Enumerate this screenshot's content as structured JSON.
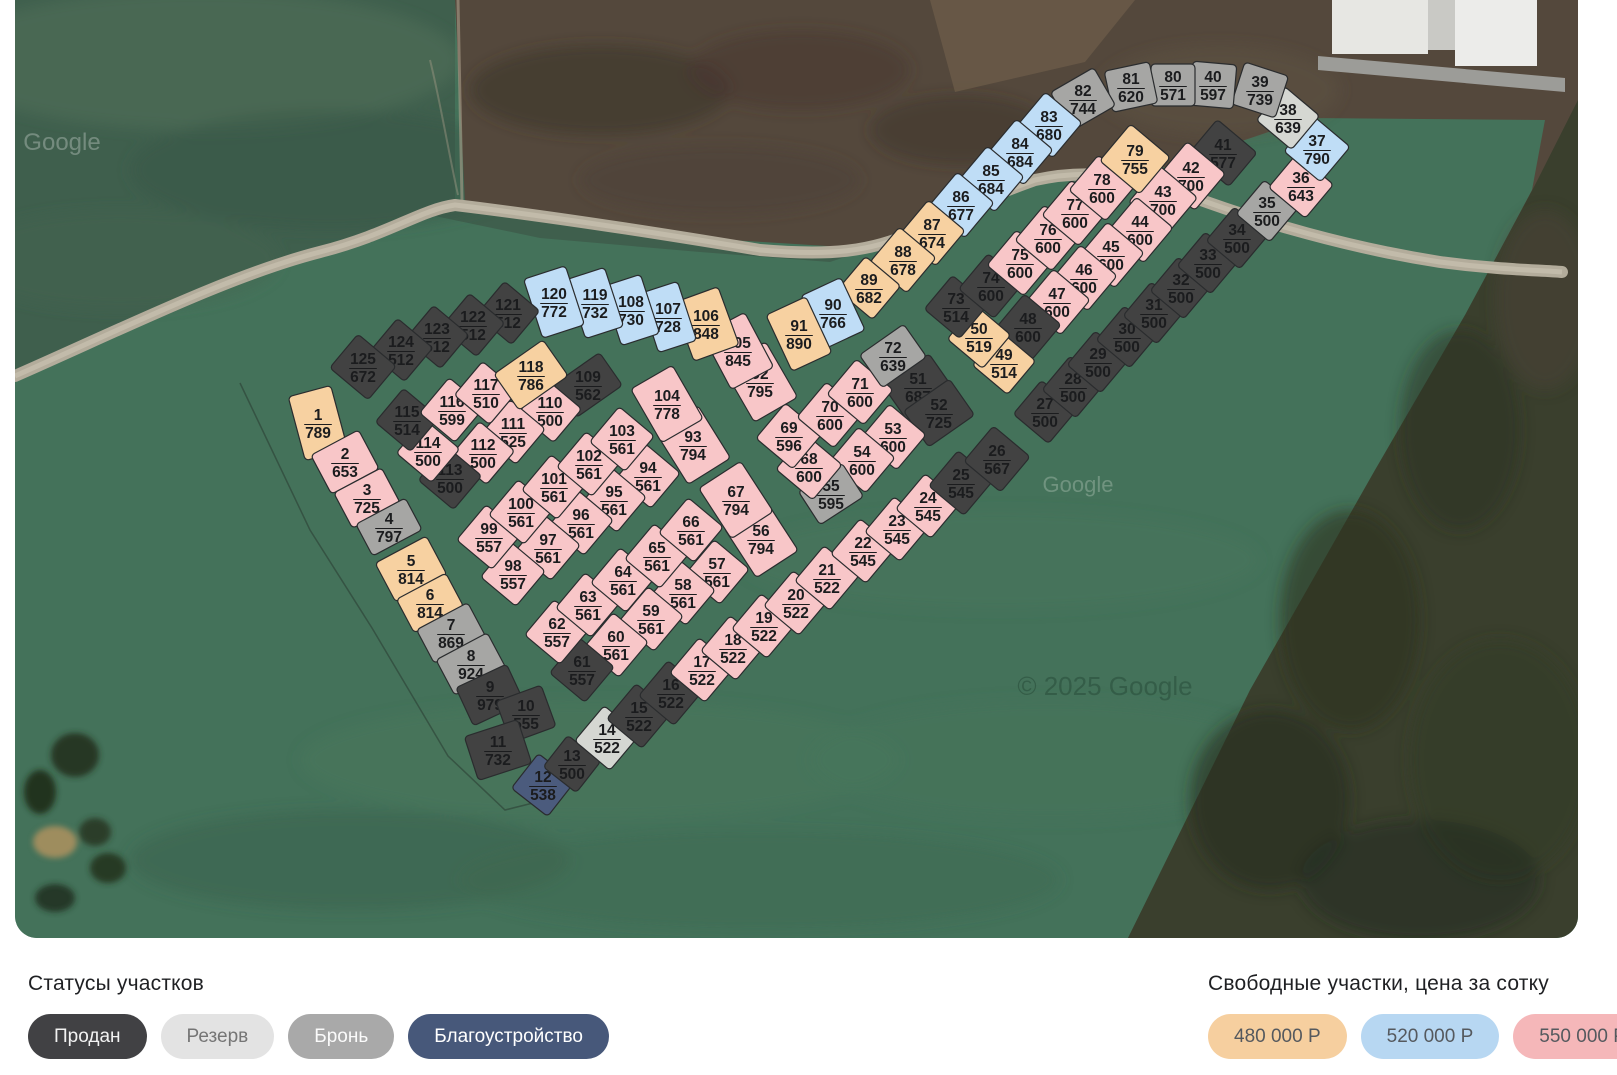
{
  "legend": {
    "statuses_title": "Статусы участков",
    "statuses": [
      {
        "key": "sold",
        "label": "Продан"
      },
      {
        "key": "reserve",
        "label": "Резерв"
      },
      {
        "key": "hold",
        "label": "Бронь"
      },
      {
        "key": "improve",
        "label": "Благоустройство"
      }
    ],
    "prices_title": "Свободные участки, цена за сотку",
    "prices": [
      {
        "key": "p480",
        "label": "480 000 Р"
      },
      {
        "key": "p520",
        "label": "520 000 Р"
      },
      {
        "key": "p550",
        "label": "550 000 Р"
      }
    ]
  },
  "pill_colors": {
    "sold": [
      "#414144",
      "#f2f2f2"
    ],
    "reserve": [
      "#e3e3e3",
      "#757575"
    ],
    "hold": [
      "#a9a9a9",
      "#fbfbfb"
    ],
    "improve": [
      "#47587a",
      "#ffffff"
    ],
    "p480": [
      "#f6cf9f",
      "#55595e"
    ],
    "p520": [
      "#b7d7f2",
      "#55595e"
    ],
    "p550": [
      "#f5b7b9",
      "#55595e"
    ]
  },
  "plot_colors": {
    "sold": "#424242",
    "reserve": "#d5d7d2",
    "hold": "#a6a6a4",
    "improve": "#4b5b7d",
    "p480": "#f7d1a1",
    "p520": "#bfddf6",
    "p550": "#f8c6c8"
  },
  "map_watermarks": [
    {
      "text": "Google",
      "x": 62,
      "y": 150,
      "size": 24,
      "fill": "#ffffff",
      "opacity": 0.28
    },
    {
      "text": "Google",
      "x": 1078,
      "y": 492,
      "size": 22,
      "fill": "#c2d2c6",
      "opacity": 0.35
    },
    {
      "text": "© 2025 Google",
      "x": 1105,
      "y": 695,
      "size": 26,
      "fill": "#20402f",
      "opacity": 0.4
    }
  ],
  "plots": [
    [
      1,
      789,
      "p480",
      318,
      423,
      -15,
      44,
      66
    ],
    [
      2,
      653,
      "p550",
      345,
      462,
      -28,
      54,
      44
    ],
    [
      3,
      725,
      "p550",
      367,
      498,
      -28,
      54,
      40
    ],
    [
      4,
      797,
      "hold",
      389,
      527,
      -28,
      56,
      36
    ],
    [
      5,
      814,
      "p480",
      411,
      569,
      -28,
      58,
      44
    ],
    [
      6,
      814,
      "p480",
      430,
      603,
      -28,
      56,
      38
    ],
    [
      7,
      869,
      "hold",
      451,
      633,
      -28,
      58,
      38
    ],
    [
      8,
      924,
      "hold",
      471,
      664,
      -28,
      58,
      40
    ],
    [
      9,
      979,
      "sold",
      490,
      695,
      -25,
      56,
      42
    ],
    [
      10,
      555,
      "sold",
      526,
      714,
      -20,
      48,
      44
    ],
    [
      11,
      732,
      "sold",
      498,
      750,
      -18,
      56,
      46
    ],
    [
      12,
      538,
      "improve",
      543,
      785,
      38,
      46,
      44
    ],
    [
      13,
      500,
      "sold",
      572,
      764,
      38,
      42,
      40
    ],
    [
      14,
      522,
      "reserve",
      607,
      738,
      40,
      46,
      46
    ],
    [
      15,
      522,
      "sold",
      639,
      716,
      40,
      46,
      46
    ],
    [
      16,
      522,
      "sold",
      671,
      693,
      40,
      46,
      46
    ],
    [
      17,
      522,
      "p550",
      702,
      670,
      40,
      46,
      46
    ],
    [
      18,
      522,
      "p550",
      733,
      648,
      40,
      46,
      46
    ],
    [
      19,
      522,
      "p550",
      764,
      626,
      40,
      46,
      46
    ],
    [
      20,
      522,
      "p550",
      796,
      603,
      40,
      46,
      46
    ],
    [
      21,
      522,
      "p550",
      827,
      578,
      40,
      46,
      46
    ],
    [
      22,
      545,
      "p550",
      863,
      551,
      40,
      46,
      46
    ],
    [
      23,
      545,
      "p550",
      897,
      529,
      40,
      46,
      46
    ],
    [
      24,
      545,
      "p550",
      928,
      506,
      40,
      46,
      46
    ],
    [
      25,
      545,
      "sold",
      961,
      483,
      40,
      46,
      46
    ],
    [
      26,
      567,
      "sold",
      997,
      459,
      40,
      48,
      46
    ],
    [
      27,
      500,
      "sold",
      1045,
      412,
      40,
      46,
      44
    ],
    [
      28,
      500,
      "sold",
      1073,
      387,
      40,
      44,
      44
    ],
    [
      29,
      500,
      "sold",
      1098,
      362,
      40,
      44,
      44
    ],
    [
      30,
      500,
      "sold",
      1127,
      337,
      40,
      44,
      44
    ],
    [
      31,
      500,
      "sold",
      1154,
      313,
      40,
      44,
      44
    ],
    [
      32,
      500,
      "sold",
      1181,
      288,
      40,
      44,
      44
    ],
    [
      33,
      500,
      "sold",
      1208,
      263,
      40,
      44,
      44
    ],
    [
      34,
      500,
      "sold",
      1237,
      238,
      40,
      44,
      44
    ],
    [
      35,
      500,
      "hold",
      1267,
      211,
      40,
      44,
      44
    ],
    [
      36,
      643,
      "p550",
      1301,
      186,
      40,
      48,
      44
    ],
    [
      37,
      790,
      "p520",
      1317,
      149,
      40,
      48,
      46
    ],
    [
      38,
      639,
      "reserve",
      1288,
      118,
      40,
      46,
      44
    ],
    [
      39,
      739,
      "hold",
      1260,
      90,
      18,
      46,
      44
    ],
    [
      40,
      597,
      "hold",
      1213,
      85,
      5,
      44,
      44
    ],
    [
      41,
      577,
      "sold",
      1223,
      153,
      40,
      52,
      44
    ],
    [
      42,
      700,
      "p550",
      1191,
      176,
      40,
      50,
      48
    ],
    [
      43,
      700,
      "p550",
      1163,
      200,
      40,
      50,
      48
    ],
    [
      44,
      600,
      "p550",
      1140,
      230,
      40,
      48,
      46
    ],
    [
      45,
      600,
      "p550",
      1111,
      255,
      40,
      48,
      46
    ],
    [
      46,
      600,
      "p550",
      1084,
      278,
      40,
      48,
      46
    ],
    [
      47,
      600,
      "p550",
      1057,
      302,
      40,
      48,
      46
    ],
    [
      48,
      600,
      "sold",
      1028,
      327,
      40,
      48,
      46
    ],
    [
      49,
      514,
      "p480",
      1004,
      363,
      40,
      46,
      44
    ],
    [
      50,
      519,
      "p480",
      979,
      337,
      40,
      46,
      44
    ],
    [
      51,
      687,
      "sold",
      918,
      387,
      -35,
      56,
      42
    ],
    [
      52,
      725,
      "sold",
      939,
      413,
      -35,
      56,
      44
    ],
    [
      53,
      600,
      "p550",
      893,
      437,
      40,
      48,
      46
    ],
    [
      54,
      600,
      "p550",
      862,
      460,
      40,
      48,
      46
    ],
    [
      55,
      595,
      "hold",
      831,
      494,
      -33,
      52,
      40
    ],
    [
      56,
      794,
      "p550",
      761,
      539,
      -33,
      50,
      60
    ],
    [
      57,
      561,
      "p550",
      717,
      572,
      40,
      46,
      46
    ],
    [
      58,
      561,
      "p550",
      683,
      593,
      40,
      46,
      46
    ],
    [
      59,
      561,
      "p550",
      651,
      619,
      40,
      46,
      46
    ],
    [
      60,
      561,
      "p550",
      616,
      645,
      40,
      46,
      46
    ],
    [
      61,
      557,
      "sold",
      582,
      670,
      40,
      46,
      46
    ],
    [
      62,
      557,
      "p550",
      557,
      632,
      40,
      46,
      46
    ],
    [
      63,
      561,
      "p550",
      588,
      605,
      40,
      46,
      46
    ],
    [
      64,
      561,
      "p550",
      623,
      580,
      40,
      46,
      46
    ],
    [
      65,
      561,
      "p550",
      657,
      556,
      40,
      46,
      46
    ],
    [
      66,
      561,
      "p550",
      691,
      530,
      40,
      46,
      46
    ],
    [
      67,
      794,
      "p550",
      736,
      500,
      -33,
      50,
      60
    ],
    [
      68,
      600,
      "p550",
      809,
      467,
      40,
      48,
      46
    ],
    [
      69,
      596,
      "p550",
      789,
      436,
      40,
      48,
      46
    ],
    [
      70,
      600,
      "p550",
      830,
      415,
      40,
      48,
      46
    ],
    [
      71,
      600,
      "p550",
      860,
      392,
      40,
      48,
      46
    ],
    [
      72,
      639,
      "hold",
      893,
      356,
      -35,
      54,
      40
    ],
    [
      73,
      514,
      "sold",
      956,
      307,
      40,
      46,
      44
    ],
    [
      74,
      600,
      "sold",
      991,
      286,
      40,
      46,
      46
    ],
    [
      75,
      600,
      "p550",
      1020,
      263,
      40,
      48,
      46
    ],
    [
      76,
      600,
      "p550",
      1048,
      238,
      40,
      48,
      46
    ],
    [
      77,
      600,
      "p550",
      1075,
      213,
      40,
      48,
      46
    ],
    [
      78,
      600,
      "p550",
      1102,
      188,
      40,
      48,
      46
    ],
    [
      79,
      755,
      "p480",
      1135,
      159,
      40,
      52,
      48
    ],
    [
      80,
      571,
      "hold",
      1173,
      85,
      0,
      44,
      42
    ],
    [
      81,
      620,
      "hold",
      1131,
      87,
      -12,
      46,
      42
    ],
    [
      82,
      744,
      "hold",
      1083,
      99,
      -30,
      50,
      44
    ],
    [
      83,
      680,
      "p520",
      1049,
      125,
      40,
      48,
      46
    ],
    [
      84,
      684,
      "p520",
      1020,
      152,
      40,
      48,
      46
    ],
    [
      85,
      684,
      "p520",
      991,
      179,
      40,
      48,
      46
    ],
    [
      86,
      677,
      "p520",
      961,
      205,
      40,
      48,
      46
    ],
    [
      87,
      674,
      "p480",
      932,
      233,
      40,
      48,
      46
    ],
    [
      88,
      678,
      "p480",
      903,
      260,
      40,
      48,
      46
    ],
    [
      89,
      682,
      "p480",
      869,
      288,
      40,
      46,
      44
    ],
    [
      90,
      766,
      "p520",
      833,
      313,
      -25,
      44,
      58
    ],
    [
      91,
      890,
      "p480",
      799,
      334,
      -25,
      44,
      62
    ],
    [
      92,
      795,
      "p550",
      760,
      382,
      -30,
      50,
      64
    ],
    [
      93,
      794,
      "p550",
      693,
      445,
      -32,
      50,
      62
    ],
    [
      94,
      561,
      "p550",
      648,
      476,
      40,
      46,
      46
    ],
    [
      95,
      561,
      "p550",
      614,
      500,
      40,
      46,
      46
    ],
    [
      96,
      561,
      "p550",
      581,
      523,
      40,
      46,
      46
    ],
    [
      97,
      561,
      "p550",
      548,
      548,
      40,
      46,
      46
    ],
    [
      98,
      557,
      "p550",
      513,
      574,
      40,
      46,
      46
    ],
    [
      99,
      557,
      "p550",
      489,
      537,
      40,
      46,
      46
    ],
    [
      100,
      561,
      "p550",
      521,
      512,
      40,
      46,
      46
    ],
    [
      101,
      561,
      "p550",
      554,
      487,
      40,
      46,
      46
    ],
    [
      102,
      561,
      "p550",
      589,
      464,
      40,
      46,
      46
    ],
    [
      103,
      561,
      "p550",
      622,
      439,
      40,
      46,
      46
    ],
    [
      104,
      778,
      "p550",
      667,
      404,
      -30,
      48,
      62
    ],
    [
      105,
      845,
      "p550",
      738,
      351,
      -28,
      48,
      62
    ],
    [
      106,
      848,
      "p480",
      706,
      324,
      -20,
      48,
      62
    ],
    [
      107,
      728,
      "p520",
      668,
      317,
      -18,
      40,
      62
    ],
    [
      108,
      730,
      "p520",
      631,
      310,
      -18,
      40,
      62
    ],
    [
      109,
      562,
      "sold",
      588,
      385,
      -35,
      56,
      40
    ],
    [
      110,
      500,
      "p550",
      550,
      411,
      40,
      46,
      44
    ],
    [
      111,
      525,
      "p550",
      513,
      432,
      40,
      46,
      46
    ],
    [
      112,
      500,
      "p550",
      483,
      453,
      40,
      46,
      44
    ],
    [
      113,
      500,
      "sold",
      450,
      478,
      40,
      46,
      44
    ],
    [
      114,
      500,
      "p550",
      428,
      451,
      40,
      46,
      44
    ],
    [
      115,
      514,
      "sold",
      407,
      420,
      40,
      46,
      44
    ],
    [
      116,
      599,
      "p550",
      452,
      410,
      40,
      46,
      46
    ],
    [
      117,
      510,
      "p550",
      486,
      393,
      40,
      46,
      44
    ],
    [
      118,
      786,
      "p480",
      531,
      375,
      -35,
      60,
      44
    ],
    [
      119,
      732,
      "p520",
      595,
      303,
      -18,
      40,
      62
    ],
    [
      120,
      772,
      "p520",
      554,
      302,
      -18,
      44,
      62
    ],
    [
      121,
      512,
      "sold",
      508,
      313,
      40,
      46,
      44
    ],
    [
      122,
      512,
      "sold",
      473,
      325,
      40,
      46,
      44
    ],
    [
      123,
      512,
      "sold",
      437,
      337,
      40,
      46,
      44
    ],
    [
      124,
      512,
      "sold",
      401,
      350,
      40,
      46,
      44
    ],
    [
      125,
      672,
      "sold",
      363,
      367,
      40,
      50,
      44
    ]
  ]
}
